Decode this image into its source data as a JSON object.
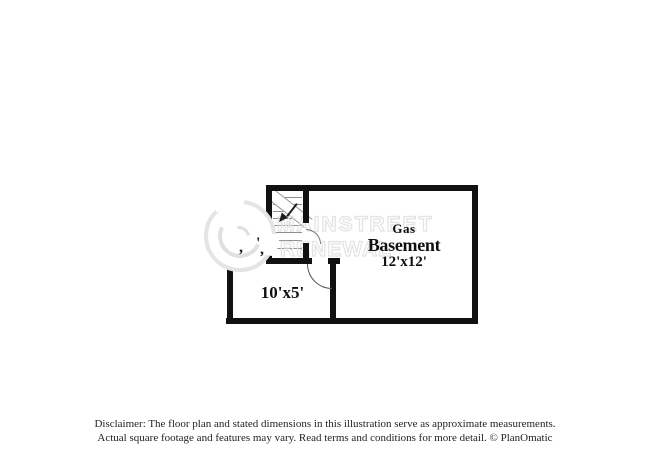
{
  "page": {
    "background_color": "#ffffff",
    "wall_color": "#111111"
  },
  "watermark": {
    "brand_line1": "MAINSTREET",
    "brand_line2": "RENEWAL",
    "color": "#e3e3e3",
    "logo": "mainstreet-renewal-circle-logo"
  },
  "floorplan": {
    "rooms": [
      {
        "id": "basement",
        "label_small": "Gas",
        "name": "Basement",
        "dimensions": "12'x12'"
      },
      {
        "id": "utility-room",
        "dimensions": "10'x5'"
      }
    ],
    "closet_dimension_fragments": [
      ",",
      "'",
      ","
    ],
    "features": [
      "staircase",
      "door-swing-main",
      "door-swing-stair",
      "chimney-alcove"
    ]
  },
  "disclaimer": {
    "line1": "Disclaimer: The floor plan and stated dimensions in this illustration serve as approximate measurements.",
    "line2": "Actual square footage and features may vary. Read terms and conditions for more detail. © PlanOmatic"
  }
}
